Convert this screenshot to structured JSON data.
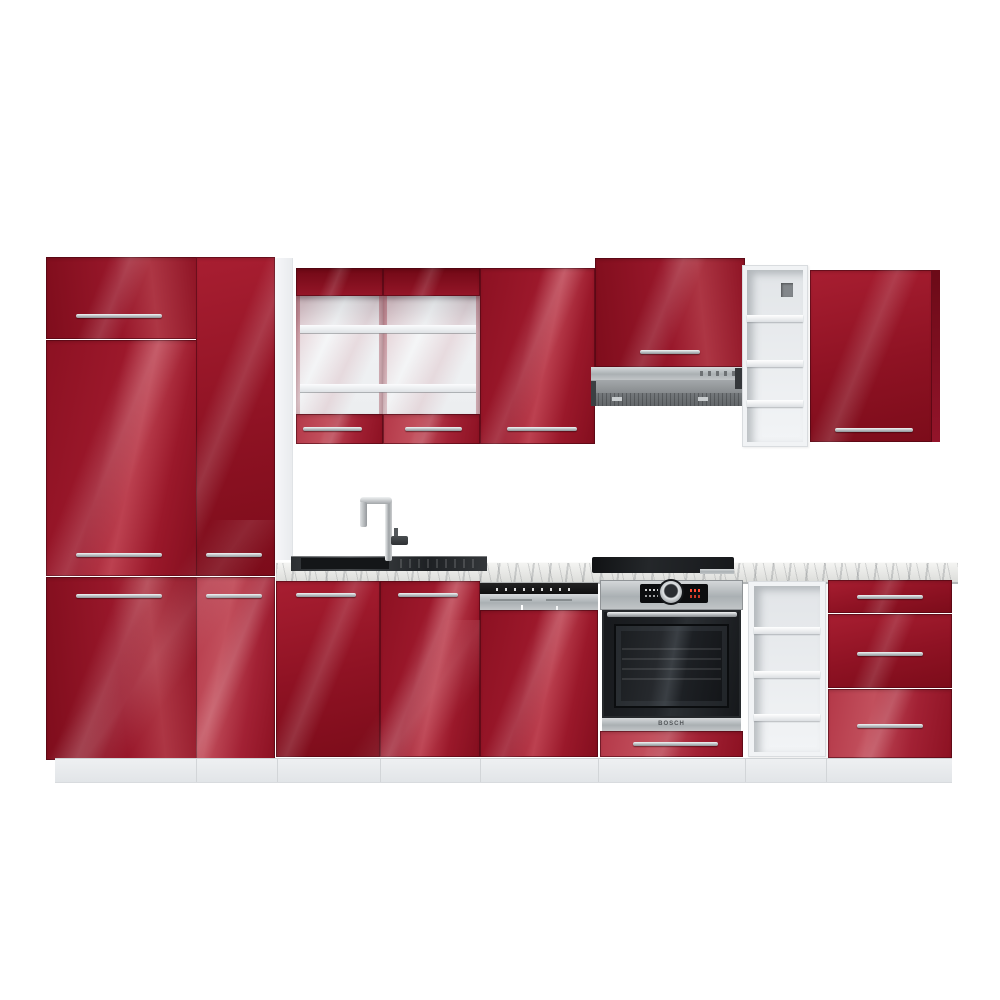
{
  "scene": {
    "type": "product-photo",
    "subject": "Modular kitchen set with high-gloss red fronts, white carcass and marble-effect worktop on a white background",
    "background": "#ffffff",
    "labels": {
      "oven_brand": "BOSCH"
    },
    "units_left_to_right": [
      "tall pantry cabinet with three red doors",
      "tall pantry cabinet with two red doors",
      "glass-door wall display cabinet with two white shelves",
      "solid red wall cabinet",
      "red wall cabinet above telescopic cooker hood",
      "open white wall shelf unit with four compartments",
      "red wall cabinet with dark side panel",
      "sink base cabinet with two red doors",
      "semi-integrated dishwasher with red furniture front",
      "built-in oven housing with red drawer below",
      "open white base shelf unit with four compartments",
      "base unit with three red drawers"
    ],
    "appliances": [
      "chrome single-lever mixer tap",
      "inset black sink with drainer",
      "stainless telescopic cooker hood",
      "semi-integrated dishwasher with stainless control strip",
      "built-in stainless electric oven with knob and red display digits",
      "black ceramic hob on worktop"
    ],
    "palette": {
      "front_red": "#9c182b",
      "front_red_dark": "#7c0c1a",
      "front_red_highlight": "#c2505d",
      "carcass_white": "#f1f3f5",
      "plinth_grey": "#e9ebed",
      "worktop_marble": "#e9eae7",
      "handle_chrome": "#c6cacd",
      "appliance_steel": "#b3b7ba",
      "appliance_black": "#17191c",
      "oven_display_accent": "#ff4a32"
    }
  }
}
